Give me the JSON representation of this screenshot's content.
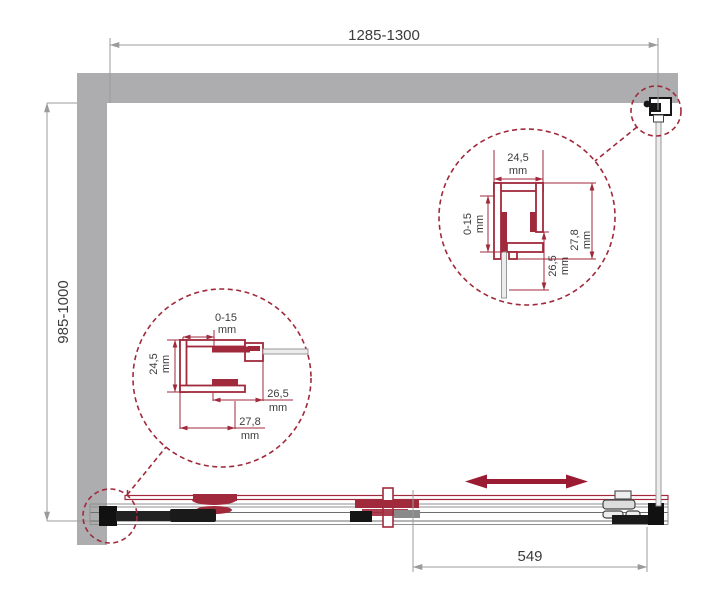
{
  "dims": {
    "width": "1285-1300",
    "depth": "985-1000",
    "door_width": "549"
  },
  "detail_top_right": {
    "top": "24,5",
    "top_unit": "mm",
    "left": "0-15",
    "left_unit": "mm",
    "inner": "26,5",
    "inner_unit": "mm",
    "outer": "27,8",
    "outer_unit": "mm"
  },
  "detail_bottom_left": {
    "top": "0-15",
    "top_unit": "mm",
    "left": "24,5",
    "left_unit": "mm",
    "right": "26,5",
    "right_unit": "mm",
    "bottom": "27,8",
    "bottom_unit": "mm"
  },
  "colors": {
    "wall_gray": "#adadaf",
    "dimension_gray": "#9b9b9b",
    "accent_maroon": "#a02a3c",
    "arrow_maroon": "#9b1b32",
    "text": "#3c3c3c"
  }
}
